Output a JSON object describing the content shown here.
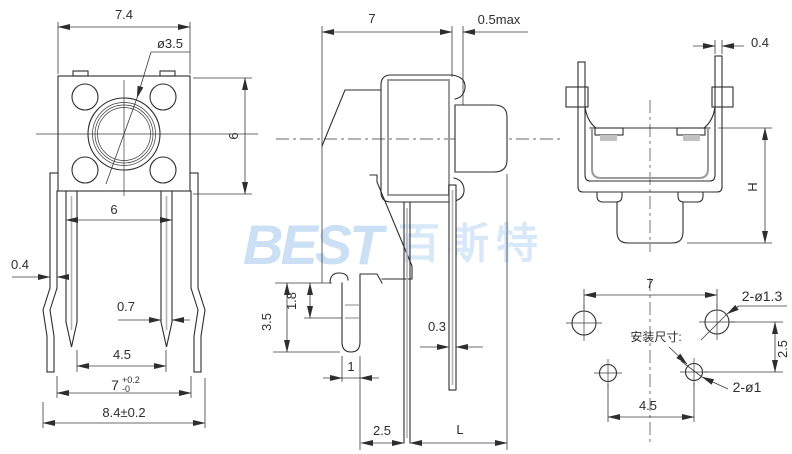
{
  "watermark": {
    "logo": "BEST",
    "cjk": "百斯特"
  },
  "top_view": {
    "width": "7.4",
    "button_dia": "ø3.5",
    "height": "6",
    "pin_outer_span": "6",
    "leg_thickness": "0.4",
    "pin_width": "0.7",
    "pin_pitch": "4.5",
    "leg_pitch": "7",
    "leg_pitch_tol_up": "+0.2",
    "leg_pitch_tol_dn": "-0",
    "overall_width": "8.4±0.2"
  },
  "side_view": {
    "body_depth": "7",
    "gap_max": "0.5max",
    "slot_depth": "1.8",
    "tab_length": "3.5",
    "pin_thickness": "0.3",
    "tab_width": "1",
    "pin_offset": "2.5",
    "total_length": "L"
  },
  "front_view": {
    "ear_thickness": "0.4",
    "height": "H"
  },
  "mounting": {
    "caption": "安装尺寸:",
    "hole_pitch_x": "7",
    "big_holes": "2-ø1.3",
    "hole_pitch_y": "2.5",
    "small_holes": "2-ø1",
    "small_hole_pitch": "4.5"
  }
}
